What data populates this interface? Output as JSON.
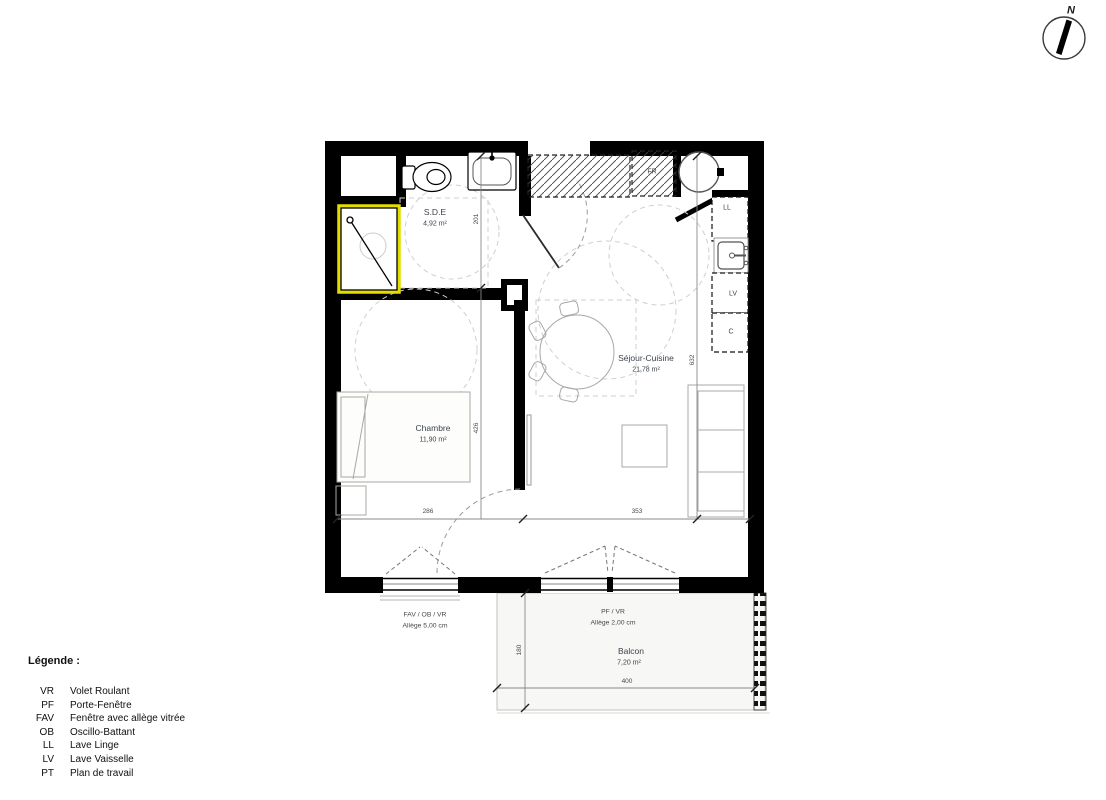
{
  "compass": {
    "label": "N"
  },
  "plan": {
    "rooms": {
      "sde": {
        "name": "S.D.E",
        "area": "4,92 m²"
      },
      "chambre": {
        "name": "Chambre",
        "area": "11,90 m²"
      },
      "sejour": {
        "name": "Séjour-Cuisine",
        "area": "21,78 m²"
      },
      "balcon": {
        "name": "Balcon",
        "area": "7,20 m²"
      }
    },
    "appliances": {
      "fridge": "FR",
      "washing_machine": "LL",
      "dishwasher": "LV",
      "cupboard": "C"
    },
    "openings": {
      "chambre_window": {
        "type": "FAV / OB / VR",
        "sill": "Allège   5,00  cm"
      },
      "sejour_window": {
        "type": "PF / VR",
        "sill": "Allège   2,00  cm"
      }
    },
    "dimensions": {
      "sde_depth": "201",
      "chambre_depth": "426",
      "sejour_depth": "632",
      "chambre_width": "286",
      "sejour_width": "353",
      "balcon_depth": "180",
      "balcon_width": "400"
    }
  },
  "legend": {
    "title": "Légende :",
    "items": [
      {
        "abbr": "VR",
        "label": "Volet Roulant"
      },
      {
        "abbr": "PF",
        "label": "Porte-Fenêtre"
      },
      {
        "abbr": "FAV",
        "label": "Fenêtre avec allège vitrée"
      },
      {
        "abbr": "OB",
        "label": "Oscillo-Battant"
      },
      {
        "abbr": "LL",
        "label": "Lave Linge"
      },
      {
        "abbr": "LV",
        "label": "Lave Vaisselle"
      },
      {
        "abbr": "PT",
        "label": "Plan de travail"
      }
    ]
  }
}
